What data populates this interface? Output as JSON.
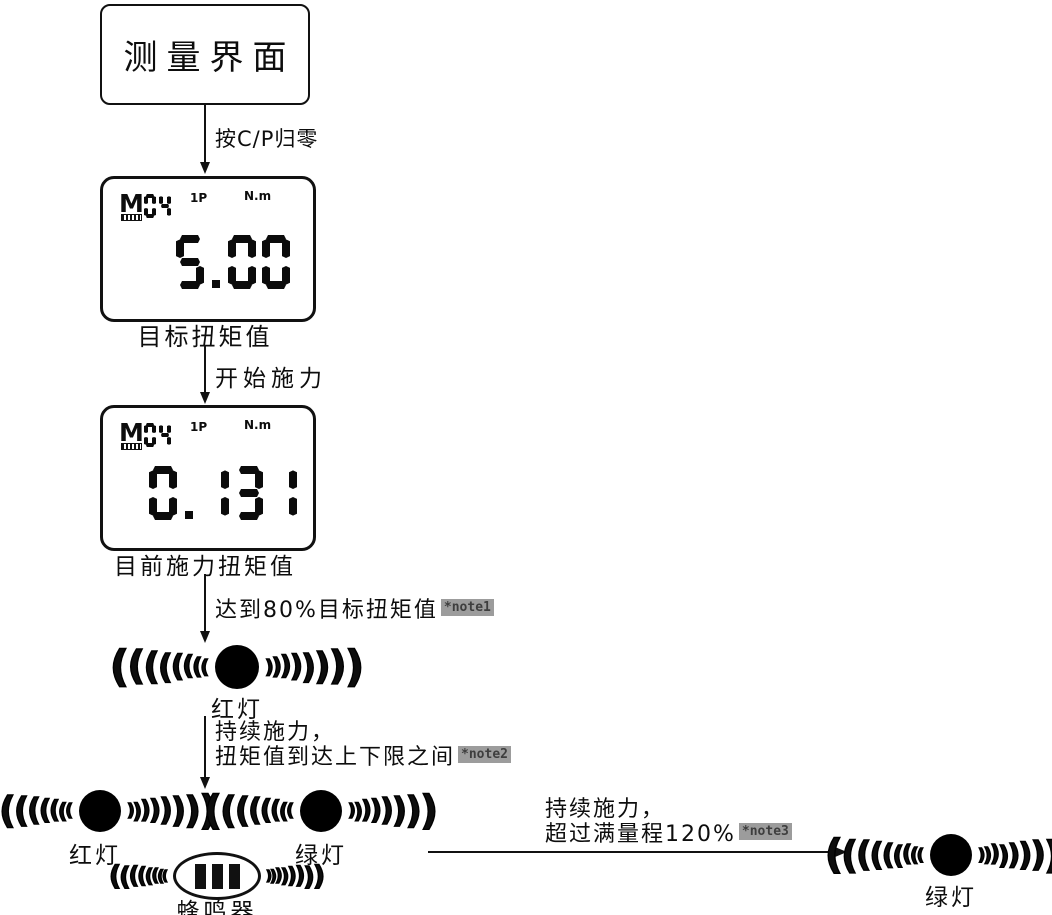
{
  "colors": {
    "ink": "#111111",
    "note_badge_bg": "#9c9c9c",
    "note_badge_text": "#3e3e3e"
  },
  "icons": {
    "wave_left": "(",
    "wave_right": ")",
    "lamp": "filled-circle",
    "buzzer": "ellipse-with-bars"
  },
  "start": {
    "label": "测量界面"
  },
  "displays": [
    {
      "mode_letter": "M",
      "mode_number": "04",
      "indicator": "1P",
      "unit": "N.m",
      "value": "5.00",
      "caption": "目标扭矩值"
    },
    {
      "mode_letter": "M",
      "mode_number": "04",
      "indicator": "1P",
      "unit": "N.m",
      "value": "0.131",
      "caption": "目前施力扭矩值"
    }
  ],
  "transitions": {
    "t1": {
      "label": "按C/P归零"
    },
    "t2": {
      "label": "开始施力"
    },
    "t3": {
      "label": "达到80%目标扭矩值",
      "note": "*note1"
    },
    "t4": {
      "label_line1": "持续施力，",
      "label_line2": "扭矩值到达上下限之间",
      "note": "*note2"
    },
    "t5": {
      "label_line1": "持续施力，",
      "label_line2": "超过满量程120%",
      "note": "*note3"
    }
  },
  "indicators": {
    "red_light_1": {
      "label": "红灯"
    },
    "red_light_2": {
      "label": "红灯"
    },
    "green_light_1": {
      "label": "绿灯"
    },
    "buzzer": {
      "label": "蜂鸣器"
    },
    "green_light_2": {
      "label": "绿灯"
    }
  }
}
